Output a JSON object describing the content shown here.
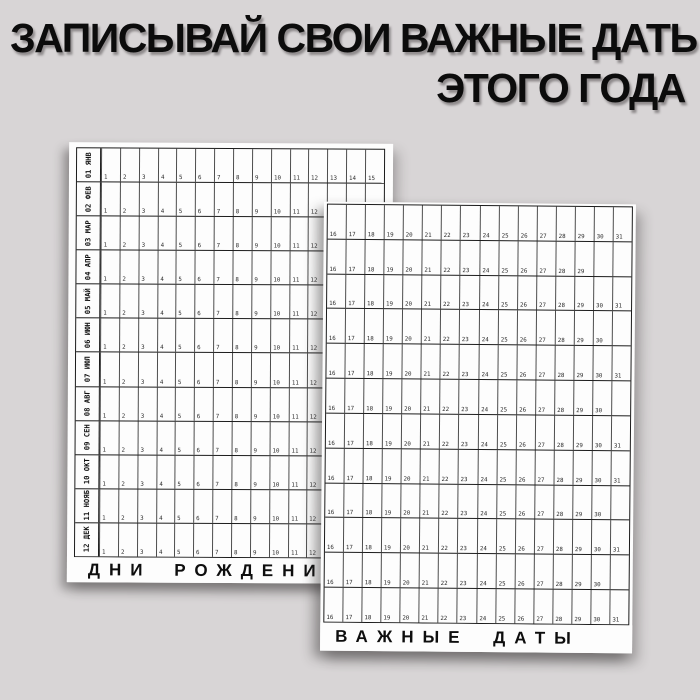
{
  "colors": {
    "page_background": "#d8d5d6",
    "paper": "#fdfdfd",
    "ink": "#1b1b1b"
  },
  "header": {
    "line1": "ЗАПИСЫВАЙ СВОИ ВАЖНЫЕ ДАТЫ",
    "line2": "ЭТОГО ГОДА"
  },
  "left_sheet": {
    "footer_title": "ДНИ РОЖДЕНИЯ",
    "day_start": 1,
    "day_end": 15,
    "months": [
      {
        "label": "01 ЯНВ"
      },
      {
        "label": "02 ФЕВ"
      },
      {
        "label": "03 МАР"
      },
      {
        "label": "04 АПР"
      },
      {
        "label": "05 МАЙ"
      },
      {
        "label": "06 ИЮН"
      },
      {
        "label": "07 ИЮЛ"
      },
      {
        "label": "08 АВГ"
      },
      {
        "label": "09 СЕН"
      },
      {
        "label": "10 ОКТ"
      },
      {
        "label": "11 НОЯБ"
      },
      {
        "label": "12 ДЕК"
      }
    ]
  },
  "right_sheet": {
    "footer_title": "ВАЖНЫЕ ДАТЫ",
    "day_start": 16,
    "day_end": 31,
    "rows": [
      {
        "last_day": 31
      },
      {
        "last_day": 29
      },
      {
        "last_day": 31
      },
      {
        "last_day": 30
      },
      {
        "last_day": 31
      },
      {
        "last_day": 30
      },
      {
        "last_day": 31
      },
      {
        "last_day": 31
      },
      {
        "last_day": 30
      },
      {
        "last_day": 31
      },
      {
        "last_day": 30
      },
      {
        "last_day": 31
      }
    ]
  }
}
